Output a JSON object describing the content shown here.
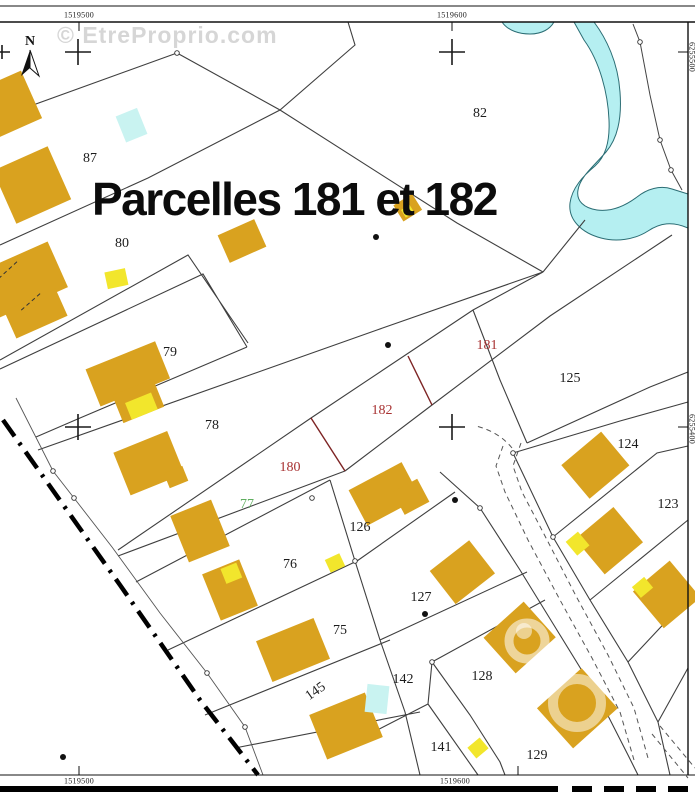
{
  "map": {
    "watermark": "© EtreProprio.com",
    "title": "Parcelles 181 et 182",
    "north_label": "N"
  },
  "coordinates": {
    "top_left": "1519500",
    "top_right": "1519600",
    "bottom_left": "1519500",
    "bottom_right": "1519600",
    "right_upper": "6255500",
    "right_lower": "6255400"
  },
  "parcels": {
    "p87": {
      "label": "87",
      "style": "plain"
    },
    "p80": {
      "label": "80",
      "style": "plain"
    },
    "p82": {
      "label": "82",
      "style": "plain"
    },
    "p79": {
      "label": "79",
      "style": "plain"
    },
    "p78": {
      "label": "78",
      "style": "plain"
    },
    "p181": {
      "label": "181",
      "style": "highlight"
    },
    "p182": {
      "label": "182",
      "style": "highlight"
    },
    "p180": {
      "label": "180",
      "style": "highlight"
    },
    "p77": {
      "label": "77",
      "style": "green"
    },
    "p125": {
      "label": "125",
      "style": "plain"
    },
    "p124": {
      "label": "124",
      "style": "plain"
    },
    "p123": {
      "label": "123",
      "style": "plain"
    },
    "p126": {
      "label": "126",
      "style": "plain"
    },
    "p76": {
      "label": "76",
      "style": "plain"
    },
    "p127": {
      "label": "127",
      "style": "plain"
    },
    "p75": {
      "label": "75",
      "style": "plain"
    },
    "p142": {
      "label": "142",
      "style": "plain"
    },
    "p128": {
      "label": "128",
      "style": "plain"
    },
    "p141": {
      "label": "141",
      "style": "plain"
    },
    "p129": {
      "label": "129",
      "style": "plain"
    },
    "r145": {
      "label": "145",
      "style": "road"
    }
  },
  "colors": {
    "building": "#d9a21f",
    "annex_yellow": "#f2e62c",
    "water": "#b5eff1",
    "water_outline": "#2b6d74",
    "highlight_parcel_text": "#a83232",
    "green_parcel_text": "#5fae5f",
    "boundary_red": "#7d2424",
    "watermark_gray": "#cccccc"
  }
}
